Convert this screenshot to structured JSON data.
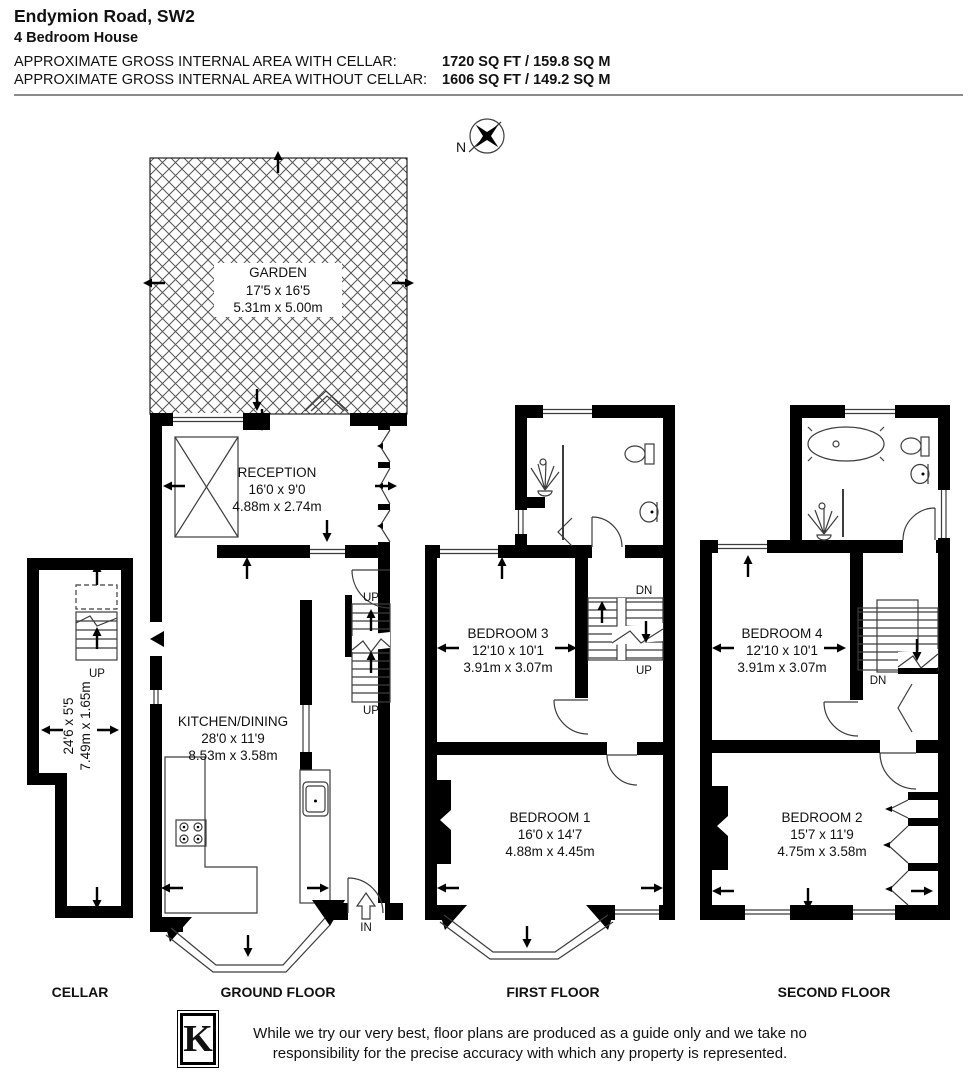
{
  "header": {
    "title": "Endymion Road, SW2",
    "subtitle": "4 Bedroom House",
    "area_with_cellar_label": "APPROXIMATE GROSS INTERNAL AREA WITH CELLAR:",
    "area_with_cellar_value": "1720 SQ FT / 159.8 SQ M",
    "area_without_cellar_label": "APPROXIMATE GROSS INTERNAL AREA WITHOUT CELLAR:",
    "area_without_cellar_value": "1606 SQ FT / 149.2 SQ M"
  },
  "compass": {
    "north_label": "N"
  },
  "rooms": {
    "garden": {
      "name": "GARDEN",
      "dims_ft": "17'5 x 16'5",
      "dims_m": "5.31m x 5.00m"
    },
    "reception": {
      "name": "RECEPTION",
      "dims_ft": "16'0 x 9'0",
      "dims_m": "4.88m x 2.74m"
    },
    "kitchen_dining": {
      "name": "KITCHEN/DINING",
      "dims_ft": "28'0 x 11'9",
      "dims_m": "8.53m x 3.58m"
    },
    "cellar": {
      "dims_ft": "24'6 x 5'5",
      "dims_m": "7.49m x 1.65m"
    },
    "bedroom_1": {
      "name": "BEDROOM 1",
      "dims_ft": "16'0 x 14'7",
      "dims_m": "4.88m x 4.45m"
    },
    "bedroom_2": {
      "name": "BEDROOM 2",
      "dims_ft": "15'7 x 11'9",
      "dims_m": "4.75m x 3.58m"
    },
    "bedroom_3": {
      "name": "BEDROOM 3",
      "dims_ft": "12'10 x 10'1",
      "dims_m": "3.91m x 3.07m"
    },
    "bedroom_4": {
      "name": "BEDROOM 4",
      "dims_ft": "12'10 x 10'1",
      "dims_m": "3.91m x 3.07m"
    }
  },
  "stair_labels": {
    "up": "UP",
    "down": "DN",
    "entrance": "IN"
  },
  "floor_labels": {
    "cellar": "CELLAR",
    "ground": "GROUND FLOOR",
    "first": "FIRST FLOOR",
    "second": "SECOND FLOOR"
  },
  "footer": {
    "logo_letter": "K",
    "disclaimer_line1": "While we try our very best, floor plans are produced as a guide only and we take no",
    "disclaimer_line2": "responsibility for the precise accuracy with which any property is represented."
  },
  "colors": {
    "wall": "#000000",
    "line": "#3c3c3c"
  }
}
